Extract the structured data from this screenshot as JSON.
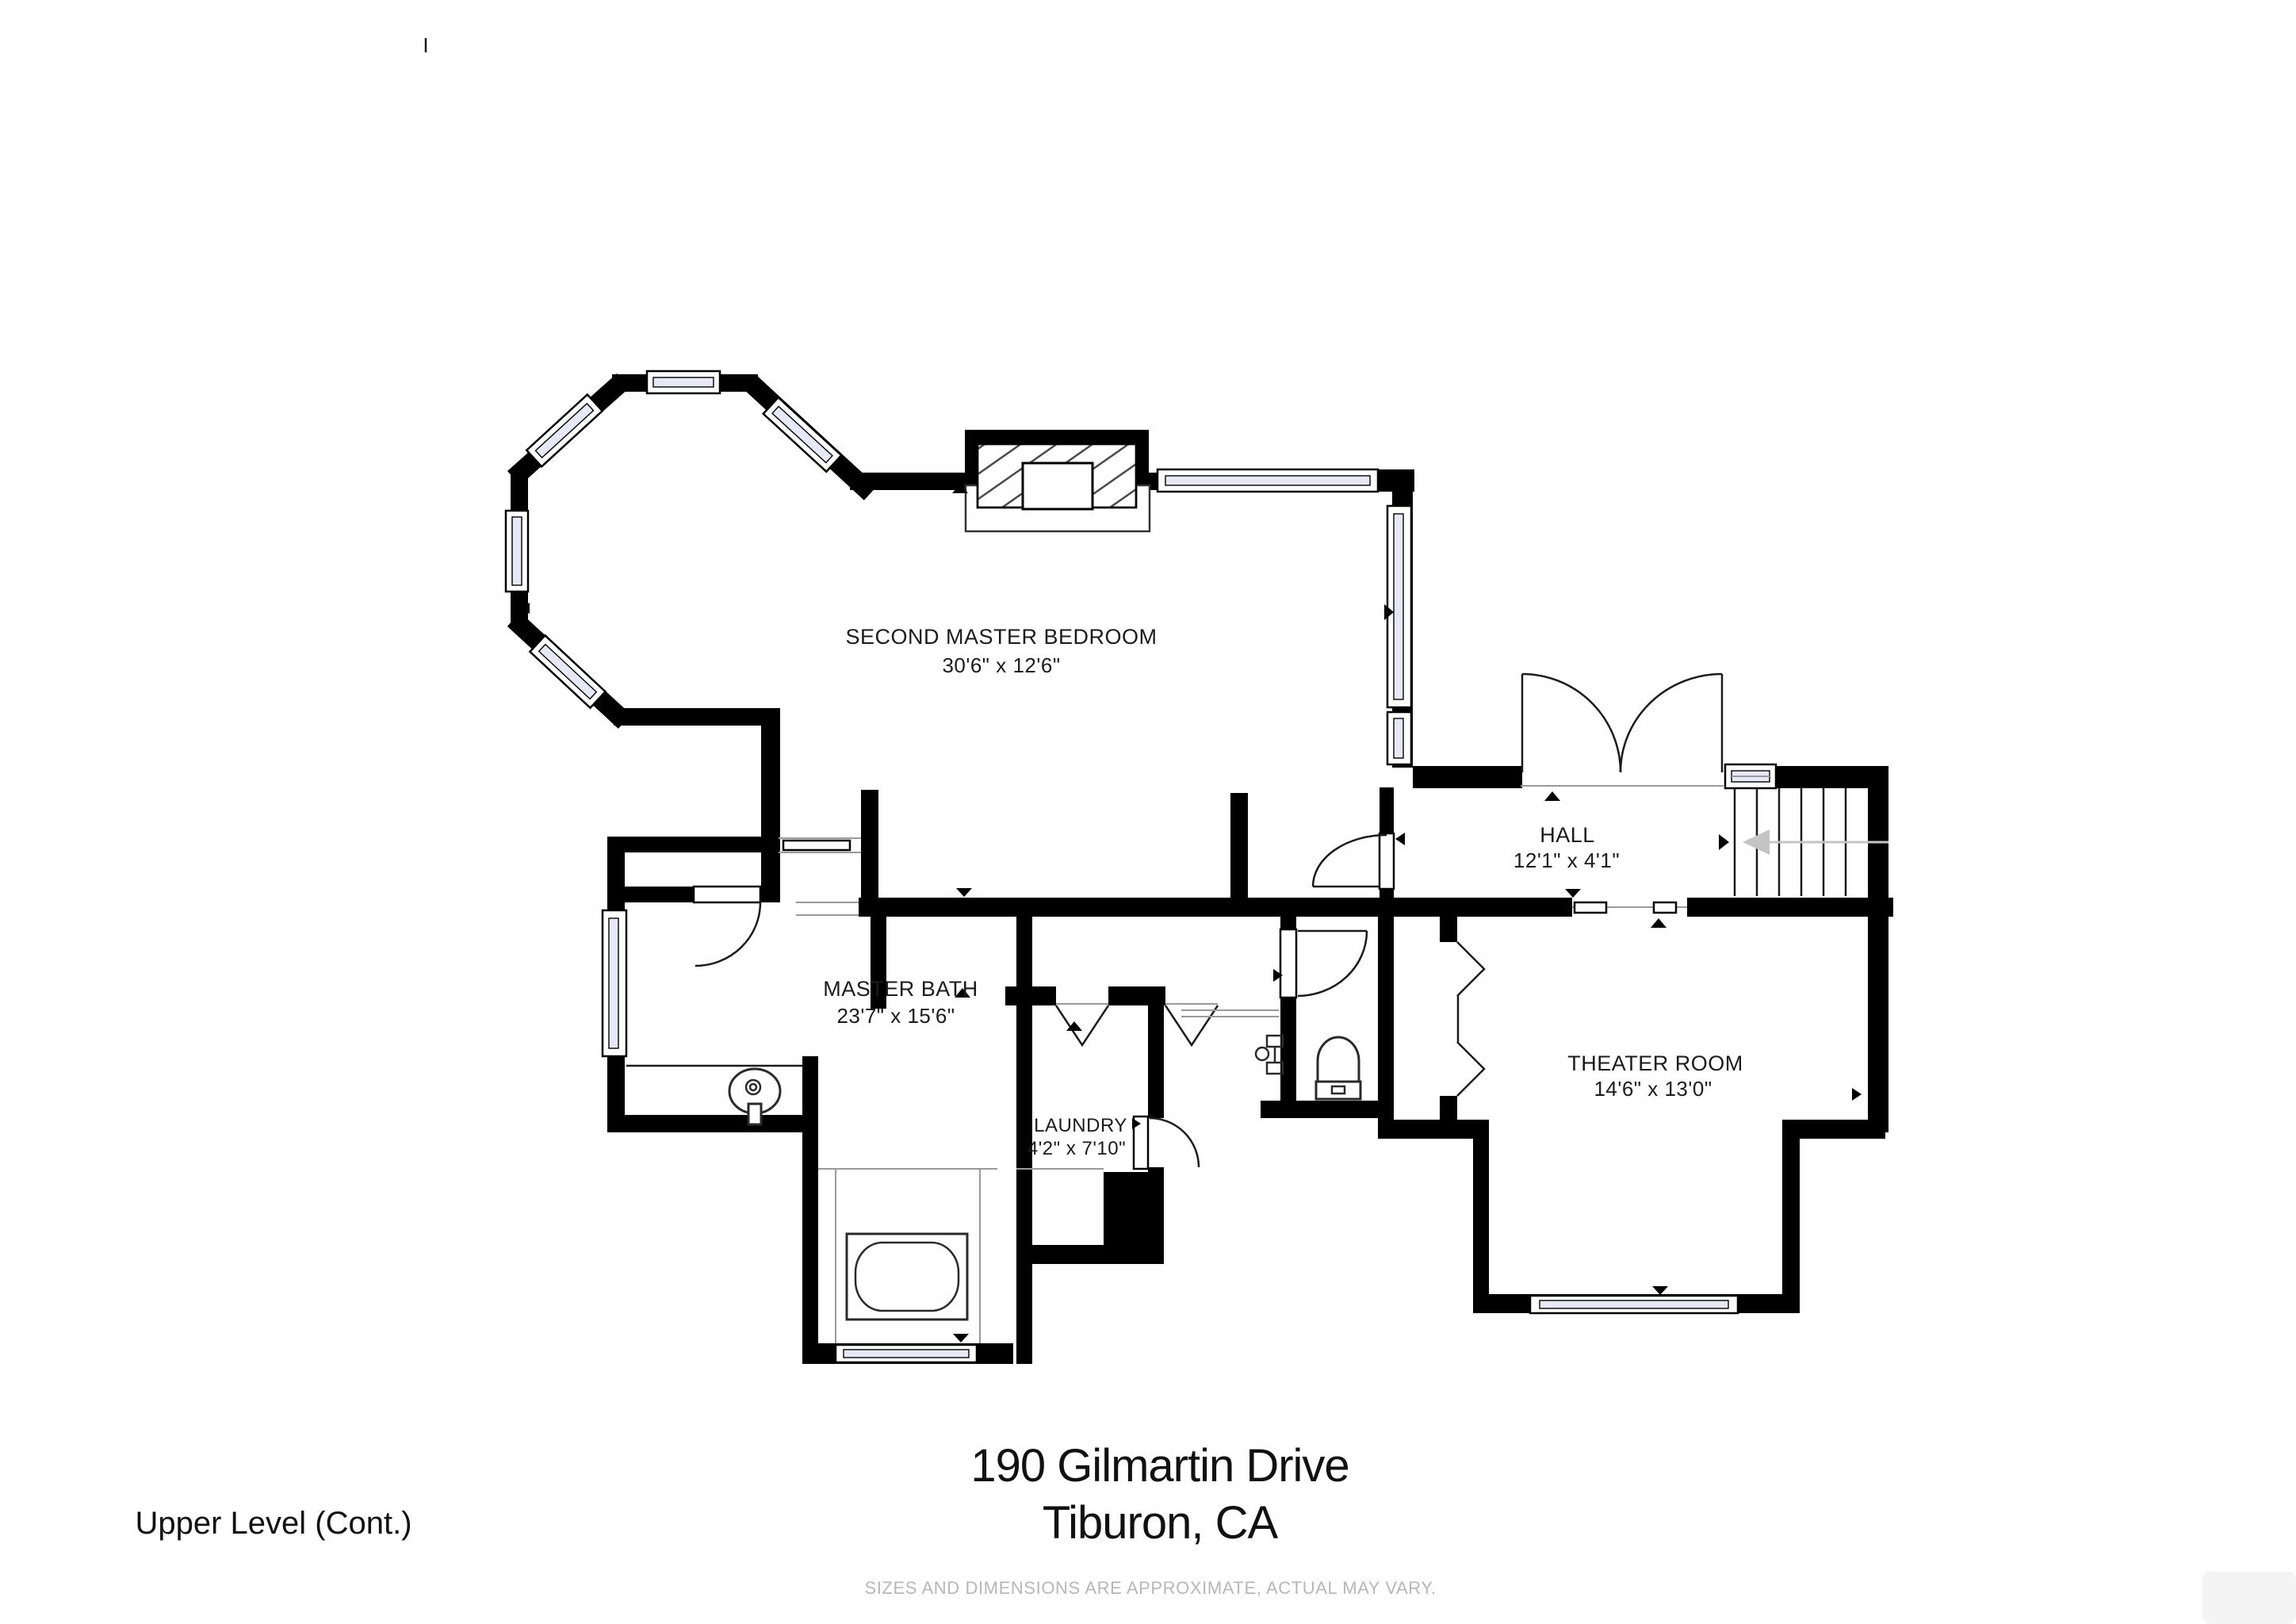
{
  "plan": {
    "rooms": [
      {
        "id": "second-master-bedroom",
        "name": "SECOND MASTER BEDROOM",
        "dims": "30'6\" x 12'6\""
      },
      {
        "id": "master-bath",
        "name": "MASTER BATH",
        "dims": "23'7\" x 15'6\""
      },
      {
        "id": "laundry",
        "name": "LAUNDRY",
        "dims": "4'2\" x 7'10\""
      },
      {
        "id": "hall",
        "name": "HALL",
        "dims": "12'1\" x 4'1\""
      },
      {
        "id": "theater-room",
        "name": "THEATER ROOM",
        "dims": "14'6\" x 13'0\""
      }
    ]
  },
  "footer": {
    "address_line1": "190 Gilmartin Drive",
    "address_line2": "Tiburon, CA",
    "level_label": "Upper Level (Cont.)",
    "disclaimer": "SIZES AND DIMENSIONS ARE APPROXIMATE, ACTUAL MAY VARY."
  },
  "colors": {
    "wall": "#000000",
    "window_pane": "#e7e7f5",
    "stair_arrow": "#c4c4c4",
    "disclaimer_text": "#b7b7b7"
  }
}
